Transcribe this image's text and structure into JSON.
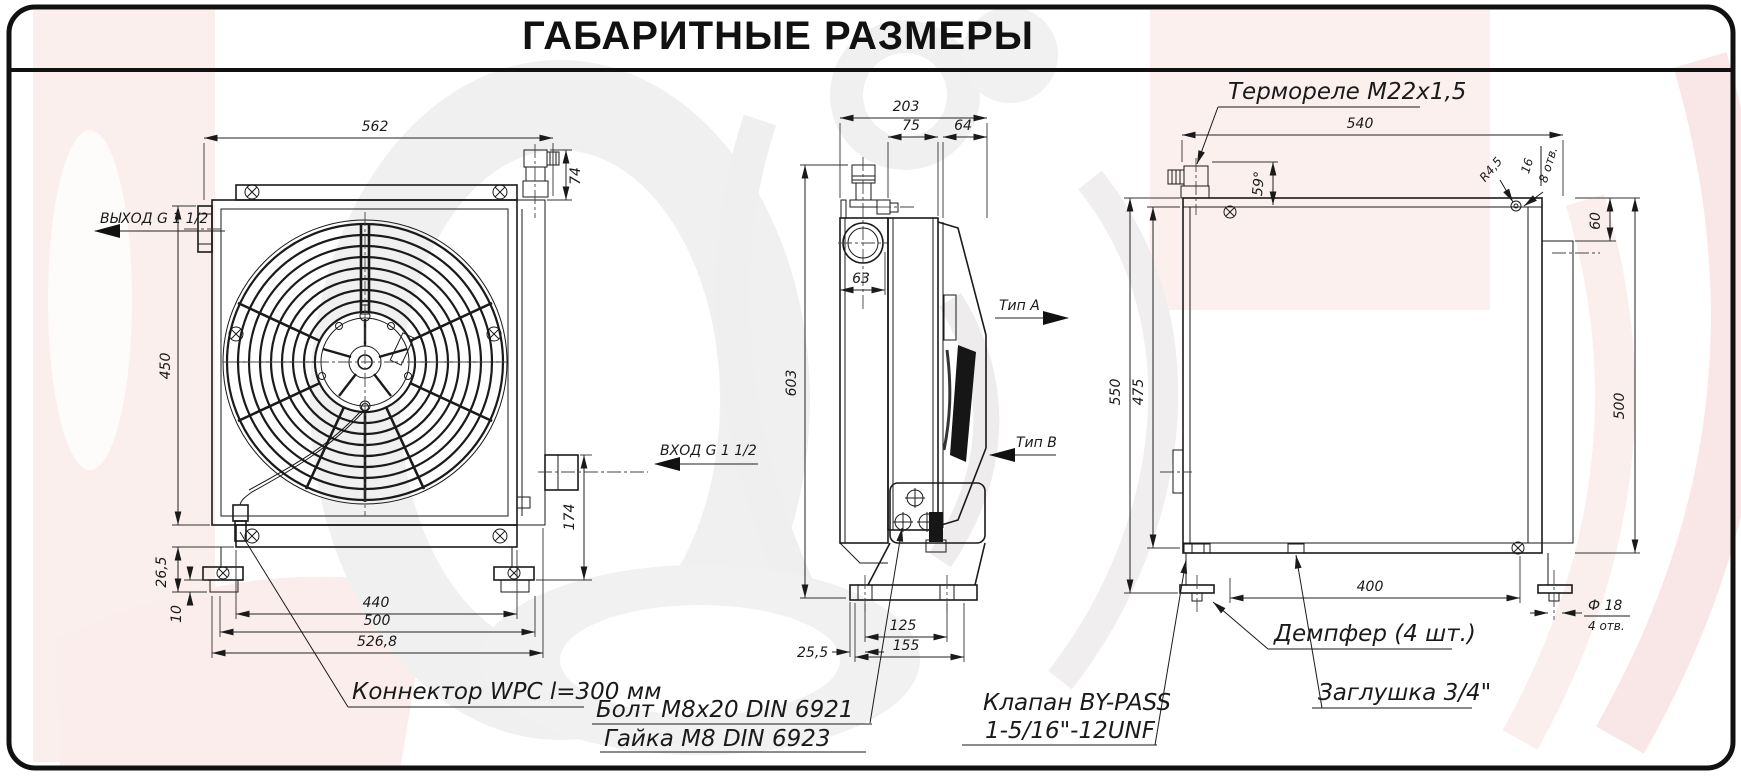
{
  "title": "ГАБАРИТНЫЕ РАЗМЕРЫ",
  "colors": {
    "ink": "#1a1a1a",
    "watermark_pink": "#fbeceb",
    "watermark_grey": "#f0f0f0"
  },
  "front": {
    "dim_width_top": "562",
    "dim_fitting": "74",
    "dim_height": "450",
    "outlet": "ВЫХОД G 1 1/2",
    "inlet": "ВХОД G 1 1/2",
    "dim_bracket": "26,5",
    "dim_foot": "10",
    "dim_flange": "440",
    "dim_mount": "500",
    "dim_overall": "526,8",
    "dim_inlet_h": "174",
    "connector": "Коннектор WPC l=300 мм"
  },
  "side": {
    "dim_depth": "203",
    "dim_core": "75",
    "dim_fan": "64",
    "dim_tank": "63",
    "dim_height": "603",
    "dim_feet": "125",
    "dim_base": "155",
    "dim_offset": "25,5",
    "type_a": "Тип А",
    "type_b": "Тип В",
    "bolt": "Болт M8x20 DIN 6921",
    "nut": "Гайка M8 DIN 6923",
    "valve1": "Клапан BY-PASS",
    "valve2": "1-5/16\"-12UNF"
  },
  "back": {
    "thermo": "Термореле M22x1,5",
    "dim_width": "540",
    "dim_angle": "59°",
    "dim_radius": "R4,5",
    "dim_hole16": "16",
    "holes8": "8 отв.",
    "dim_60": "60",
    "dim_550": "550",
    "dim_475": "475",
    "dim_500": "500",
    "dim_400": "400",
    "hole_dia": "Ф 18",
    "holes4": "4 отв.",
    "damper": "Демпфер (4 шт.)",
    "plug": "Заглушка 3/4\""
  }
}
